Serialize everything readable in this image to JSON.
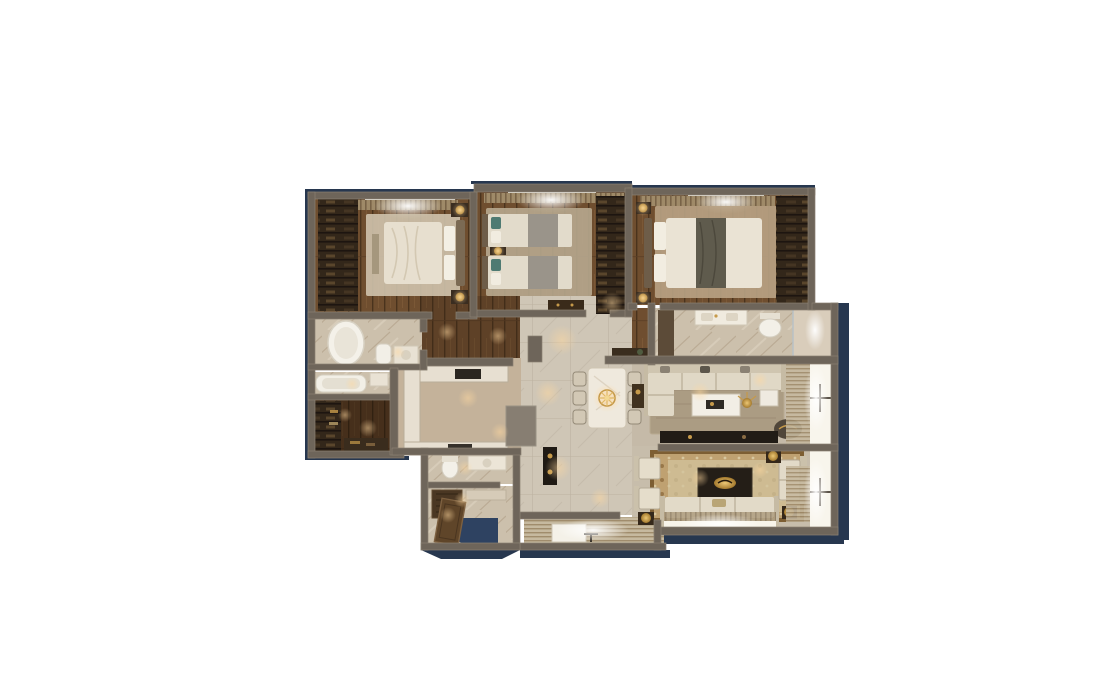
{
  "meta": {
    "title": "3D rendered apartment floor plan (top-down view)",
    "canvas": {
      "width": 1096,
      "height": 693
    },
    "background_color": "#ffffff",
    "visible_text": [],
    "shadow": {
      "color": "#27374f",
      "direction": "right-bottom"
    }
  },
  "palette": {
    "wall": "#6e655a",
    "wall_highlight": "#8a8172",
    "shadow_navy": "#27374f",
    "entry_navy": "#2e4261",
    "wood_plank": "#6f4e2f",
    "wood_dark": "#3f2c19",
    "wardrobe": "#33271a",
    "marble": "#ccc0ac",
    "tile_hall": "#cfc6b6",
    "tile_kitchen": "#c4b29a",
    "rug_beige": "#cfc3ad",
    "rug_ornate": "#bfa171",
    "rug_field": "#d3c49e",
    "fabric_cream": "#e2dac8",
    "fabric_gray": "#9a948a",
    "teal_pillow": "#4e7a72",
    "brass": "#c69a4a",
    "dark_stone": "#211c16",
    "window_glow": "#faf7ef",
    "warm_light": "#ffd9a0"
  },
  "rooms": [
    {
      "id": "master-bedroom",
      "label": "Master bedroom",
      "position": "top-left",
      "furniture": [
        "double bed",
        "wardrobe shelving",
        "two nightstands with brass lamps",
        "bench",
        "area rug",
        "window with curtains"
      ]
    },
    {
      "id": "twin-bedroom",
      "label": "Twin bedroom",
      "position": "top-center",
      "furniture": [
        "twin bed",
        "twin bed",
        "shared nightstand with brass lamp",
        "wardrobe",
        "dresser",
        "area rug",
        "window with curtains"
      ]
    },
    {
      "id": "bedroom-3",
      "label": "Bedroom",
      "position": "top-right",
      "furniture": [
        "double bed with dark throw",
        "wardrobe shelving",
        "two nightstands with brass lamps",
        "area rug",
        "window with curtains"
      ]
    },
    {
      "id": "master-bathroom",
      "label": "Master bathroom",
      "position": "mid-left",
      "furniture": [
        "freestanding oval tub",
        "toilet",
        "vanity with sink"
      ]
    },
    {
      "id": "second-bathroom",
      "label": "Bathroom",
      "position": "mid-left",
      "furniture": [
        "bathtub",
        "sink"
      ]
    },
    {
      "id": "walk-in-closet",
      "label": "Walk-in closet",
      "position": "bottom-left",
      "furniture": [
        "shelving with clothes",
        "lower shelf unit"
      ]
    },
    {
      "id": "hallway",
      "label": "Hallway corridor",
      "position": "center-left",
      "furniture": [
        "wood plank floor"
      ]
    },
    {
      "id": "kitchen",
      "label": "Kitchen",
      "position": "center-left",
      "furniture": [
        "U-shaped marble counter",
        "cooktop",
        "sink",
        "peninsula block"
      ]
    },
    {
      "id": "dining-hall",
      "label": "Dining hall",
      "position": "center",
      "furniture": [
        "marble dining table",
        "six chairs",
        "gold chandelier",
        "dark console with gold vases",
        "ceiling spotlights"
      ]
    },
    {
      "id": "guest-bathroom",
      "label": "Guest bathroom",
      "position": "bottom-center",
      "furniture": [
        "toilet",
        "vanity with sink"
      ]
    },
    {
      "id": "utility-room",
      "label": "Utility room",
      "position": "bottom-center",
      "furniture": [
        "wood cabinet",
        "marble ledge"
      ]
    },
    {
      "id": "entry",
      "label": "Entry",
      "position": "bottom",
      "furniture": [
        "open entry door leaf",
        "navy floor mat"
      ]
    },
    {
      "id": "shower-bathroom",
      "label": "Shower bathroom",
      "position": "right-top",
      "furniture": [
        "double vanity",
        "toilet",
        "walk-in shower",
        "cabinet"
      ]
    },
    {
      "id": "living-room",
      "label": "Living room",
      "position": "right-center",
      "furniture": [
        "L-shaped sectional sofa",
        "marble coffee table",
        "gold floral decor",
        "side tables",
        "round lounge pouf",
        "TV media console",
        "area rug",
        "floor-to-ceiling windows with blinds"
      ]
    },
    {
      "id": "family-lounge",
      "label": "Family lounge",
      "position": "bottom-right",
      "furniture": [
        "three-seat sofa",
        "two armchairs",
        "loveseat",
        "black marble coffee table with gold bowl",
        "persian rug",
        "side tables with brass lamps",
        "windows with blinds"
      ]
    },
    {
      "id": "window-bay",
      "label": "Window bay / balcony",
      "position": "bottom",
      "furniture": [
        "white bench",
        "slatted deck light"
      ]
    }
  ],
  "lighting": {
    "ceiling_spots_color": "#ffd9a0",
    "window_light_color": "#faf7ef",
    "lamp_color": "#c69a4a"
  }
}
